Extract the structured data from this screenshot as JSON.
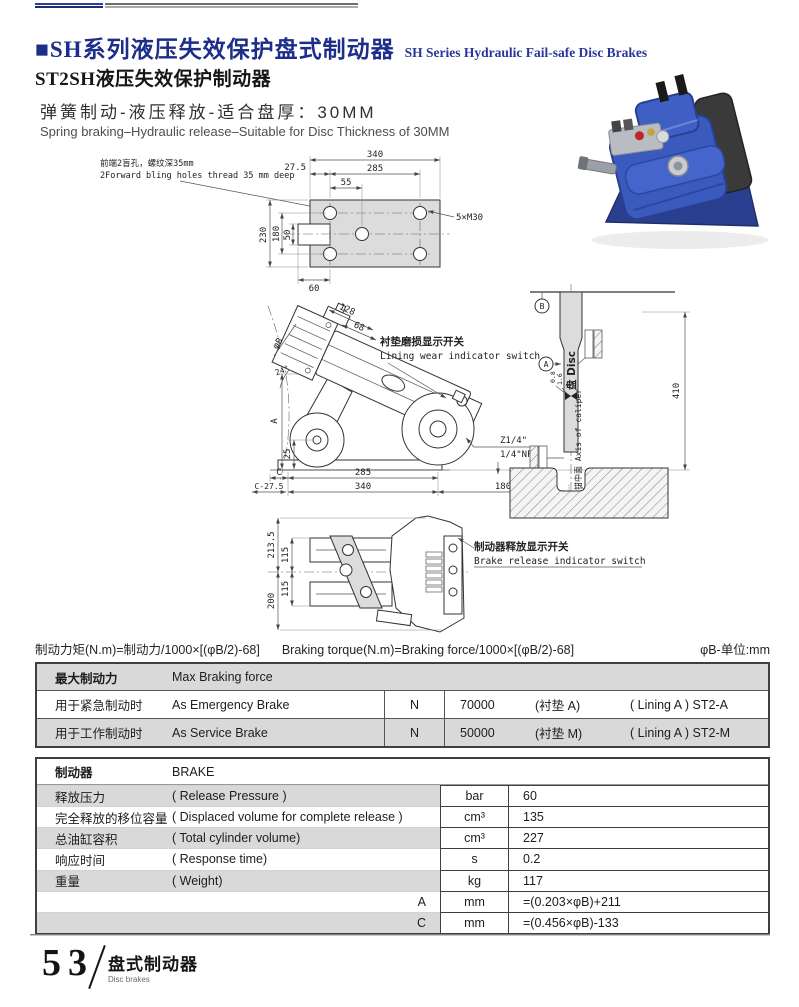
{
  "header": {
    "title_cn": "■SH系列液压失效保护盘式制动器",
    "title_en": "SH Series Hydraulic Fail-safe Disc Brakes",
    "model_title": "ST2SH液压失效保护制动器",
    "feature_cn": "弹簧制动-液压释放-适合盘厚：30MM",
    "feature_en": "Spring braking–Hydraulic release–Suitable for Disc Thickness of 30MM"
  },
  "drawings": {
    "top_view": {
      "note_cn": "前端2盲孔，螺纹深35mm",
      "note_en": "2Forward bling holes thread 35 mm deep",
      "dim_340": "340",
      "dim_27_5": "27.5",
      "dim_285": "285",
      "dim_55": "55",
      "thread_label": "5×M30",
      "dim_230": "230",
      "dim_180": "180",
      "dim_50": "50",
      "dim_60": "60"
    },
    "side_view": {
      "dim_128": "128",
      "dim_68": "68",
      "dim_phiB": "φB",
      "dim_24": "24°",
      "dim_A": "A",
      "dim_25": "25",
      "dim_C": "C",
      "dim_285": "285",
      "dim_C27_5": "C-27.5",
      "dim_340": "340",
      "dim_180": "180",
      "dim_410": "410",
      "port_1": "Z1/4\"",
      "port_2": "1/4\"NPT",
      "switch_cn": "衬垫磨损显示开关",
      "switch_en": "Lining wear indicator switch"
    },
    "disc_view": {
      "label_A": "A",
      "label_B": "B",
      "disc_label": "盘 Disc",
      "axis_label": "卡钳中面 Axis of caliper",
      "dim_0_8": "0.8",
      "dim_1_6": "1.6"
    },
    "plan_view": {
      "dim_213_5": "213.5",
      "dim_115a": "115",
      "dim_115b": "115",
      "dim_200": "200",
      "switch_cn": "制动器释放显示开关",
      "switch_en": "Brake release indicator switch"
    }
  },
  "formula": {
    "cn": "制动力矩(N.m)=制动力/1000×[(φB/2)-68]",
    "en": "Braking torque(N.m)=Braking force/1000×[(φB/2)-68]",
    "unit_note": "φB-单位:mm"
  },
  "braking_table": {
    "header_cn": "最大制动力",
    "header_en": "Max Braking force",
    "rows": [
      {
        "label_cn": "用于紧急制动时",
        "label_en": "As Emergency Brake",
        "unit": "N",
        "value": "70000",
        "lining_cn": "(衬垫 A)",
        "lining_en": "( Lining A ) ST2-A"
      },
      {
        "label_cn": "用于工作制动时",
        "label_en": "As Service Brake",
        "unit": "N",
        "value": "50000",
        "lining_cn": "(衬垫 M)",
        "lining_en": "( Lining A ) ST2-M"
      }
    ]
  },
  "spec_table": {
    "header_cn": "制动器",
    "header_en": "BRAKE",
    "rows": [
      {
        "label_cn": "释放压力",
        "label_en": "( Release Pressure )",
        "unit": "bar",
        "value": "60"
      },
      {
        "label_cn": "完全释放的移位容量",
        "label_en": "( Displaced volume for complete release )",
        "unit": "cm³",
        "value": "135"
      },
      {
        "label_cn": "总油缸容积",
        "label_en": "( Total cylinder volume)",
        "unit": "cm³",
        "value": "227"
      },
      {
        "label_cn": "响应时间",
        "label_en": "( Response time)",
        "unit": "s",
        "value": "0.2"
      },
      {
        "label_cn": "重量",
        "label_en": "( Weight)",
        "unit": "kg",
        "value": "117"
      },
      {
        "side_label": "A",
        "unit": "mm",
        "value": "=(0.203×φB)+211"
      },
      {
        "side_label": "C",
        "unit": "mm",
        "value": "=(0.456×φB)-133"
      }
    ]
  },
  "footer": {
    "page_number": "53",
    "section_cn": "盘式制动器",
    "section_en": "Disc brakes"
  },
  "colors": {
    "accent_blue": "#1c2d8a",
    "table_stripe": "#d9d9d9",
    "product_blue": "#3b5abe"
  }
}
